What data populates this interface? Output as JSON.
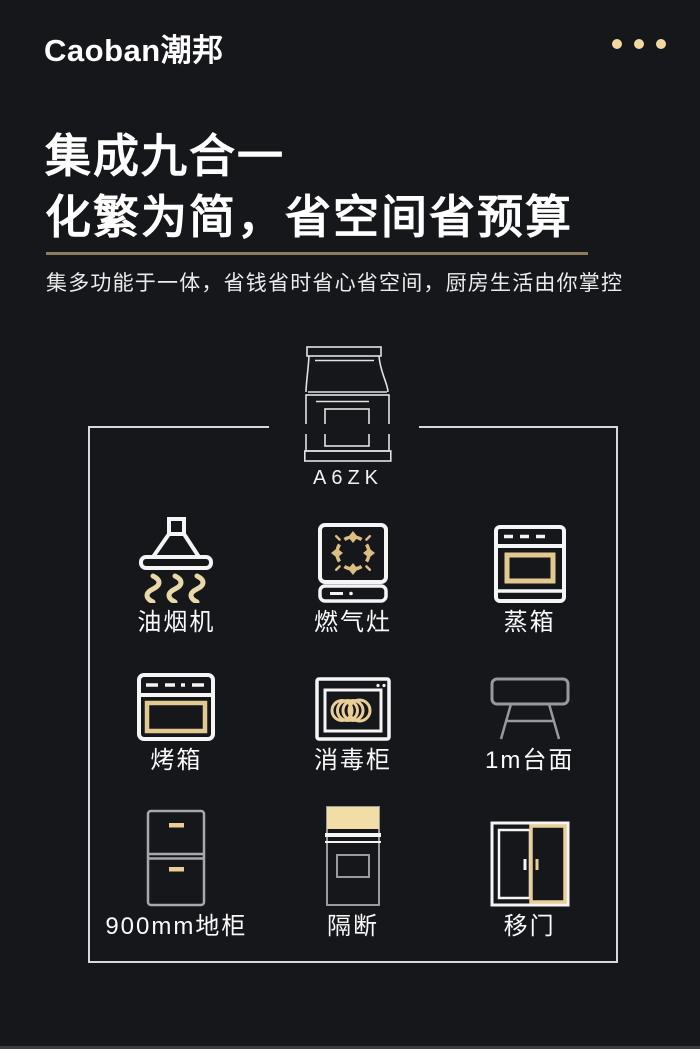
{
  "brand": {
    "logo_text": "Caoban潮邦"
  },
  "hero": {
    "title_line1": "集成九合一",
    "title_line2": "化繁为简，省空间省预算",
    "subtitle": "集多功能于一体，省钱省时省心省空间，厨房生活由你掌控"
  },
  "product": {
    "model": "A6ZK"
  },
  "features": [
    {
      "id": "range-hood",
      "label": "油烟机"
    },
    {
      "id": "gas-stove",
      "label": "燃气灶"
    },
    {
      "id": "steam-oven",
      "label": "蒸箱"
    },
    {
      "id": "oven",
      "label": "烤箱"
    },
    {
      "id": "disinfection-cabinet",
      "label": "消毒柜"
    },
    {
      "id": "countertop-1m",
      "label": "1m台面"
    },
    {
      "id": "base-cabinet-900mm",
      "label": "900mm地柜"
    },
    {
      "id": "partition",
      "label": "隔断"
    },
    {
      "id": "sliding-door",
      "label": "移门"
    }
  ],
  "colors": {
    "background": "#16171b",
    "gold": "#e9cf97",
    "gold_pale": "#f2dda6",
    "divider": "#8d7c5e",
    "frame_border": "#d9d9d9",
    "icon_white": "#f5f5f6",
    "icon_gray": "#98999b"
  }
}
